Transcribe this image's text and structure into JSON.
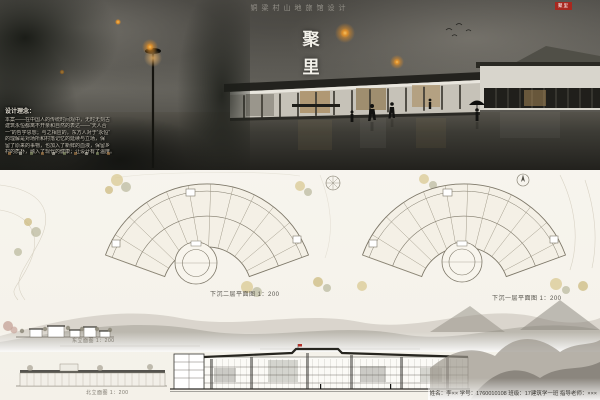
{
  "poster": {
    "project_title": "铜梁村山地旅馆设计",
    "main_title_chars": [
      "聚",
      "里"
    ],
    "seal_text": "聚里"
  },
  "design_notes": {
    "heading": "设计理念：",
    "lines": [
      "本案——在中国人的传统时间观中，无时无刻古",
      "建筑永恒都离不开亲和自然的表达——“天人合",
      "一”的哲学思想；与之相应的，东方人对于“永恒”",
      "的理解是对场所和村落记忆的延续与立场，保",
      "留了原来的事物，也加入了新鲜的血液，保留乡",
      "村的质朴，融入了现代的健康；让设计有了温度。"
    ]
  },
  "plans": {
    "left_caption": "下沉二层平面图 1：200",
    "right_caption": "下沉一层平面图 1：200"
  },
  "elevations": {
    "east_caption": "东立面图 1：200",
    "north_caption": "北立面图 1：200"
  },
  "credits": {
    "line": "姓名：李××   学号：1760010108   班级：17建筑学一班   指导老师：×××"
  },
  "colors": {
    "accent_red": "#a8281f",
    "lantern_orange": "#e8a33d",
    "paper": "#f7f5ef"
  }
}
